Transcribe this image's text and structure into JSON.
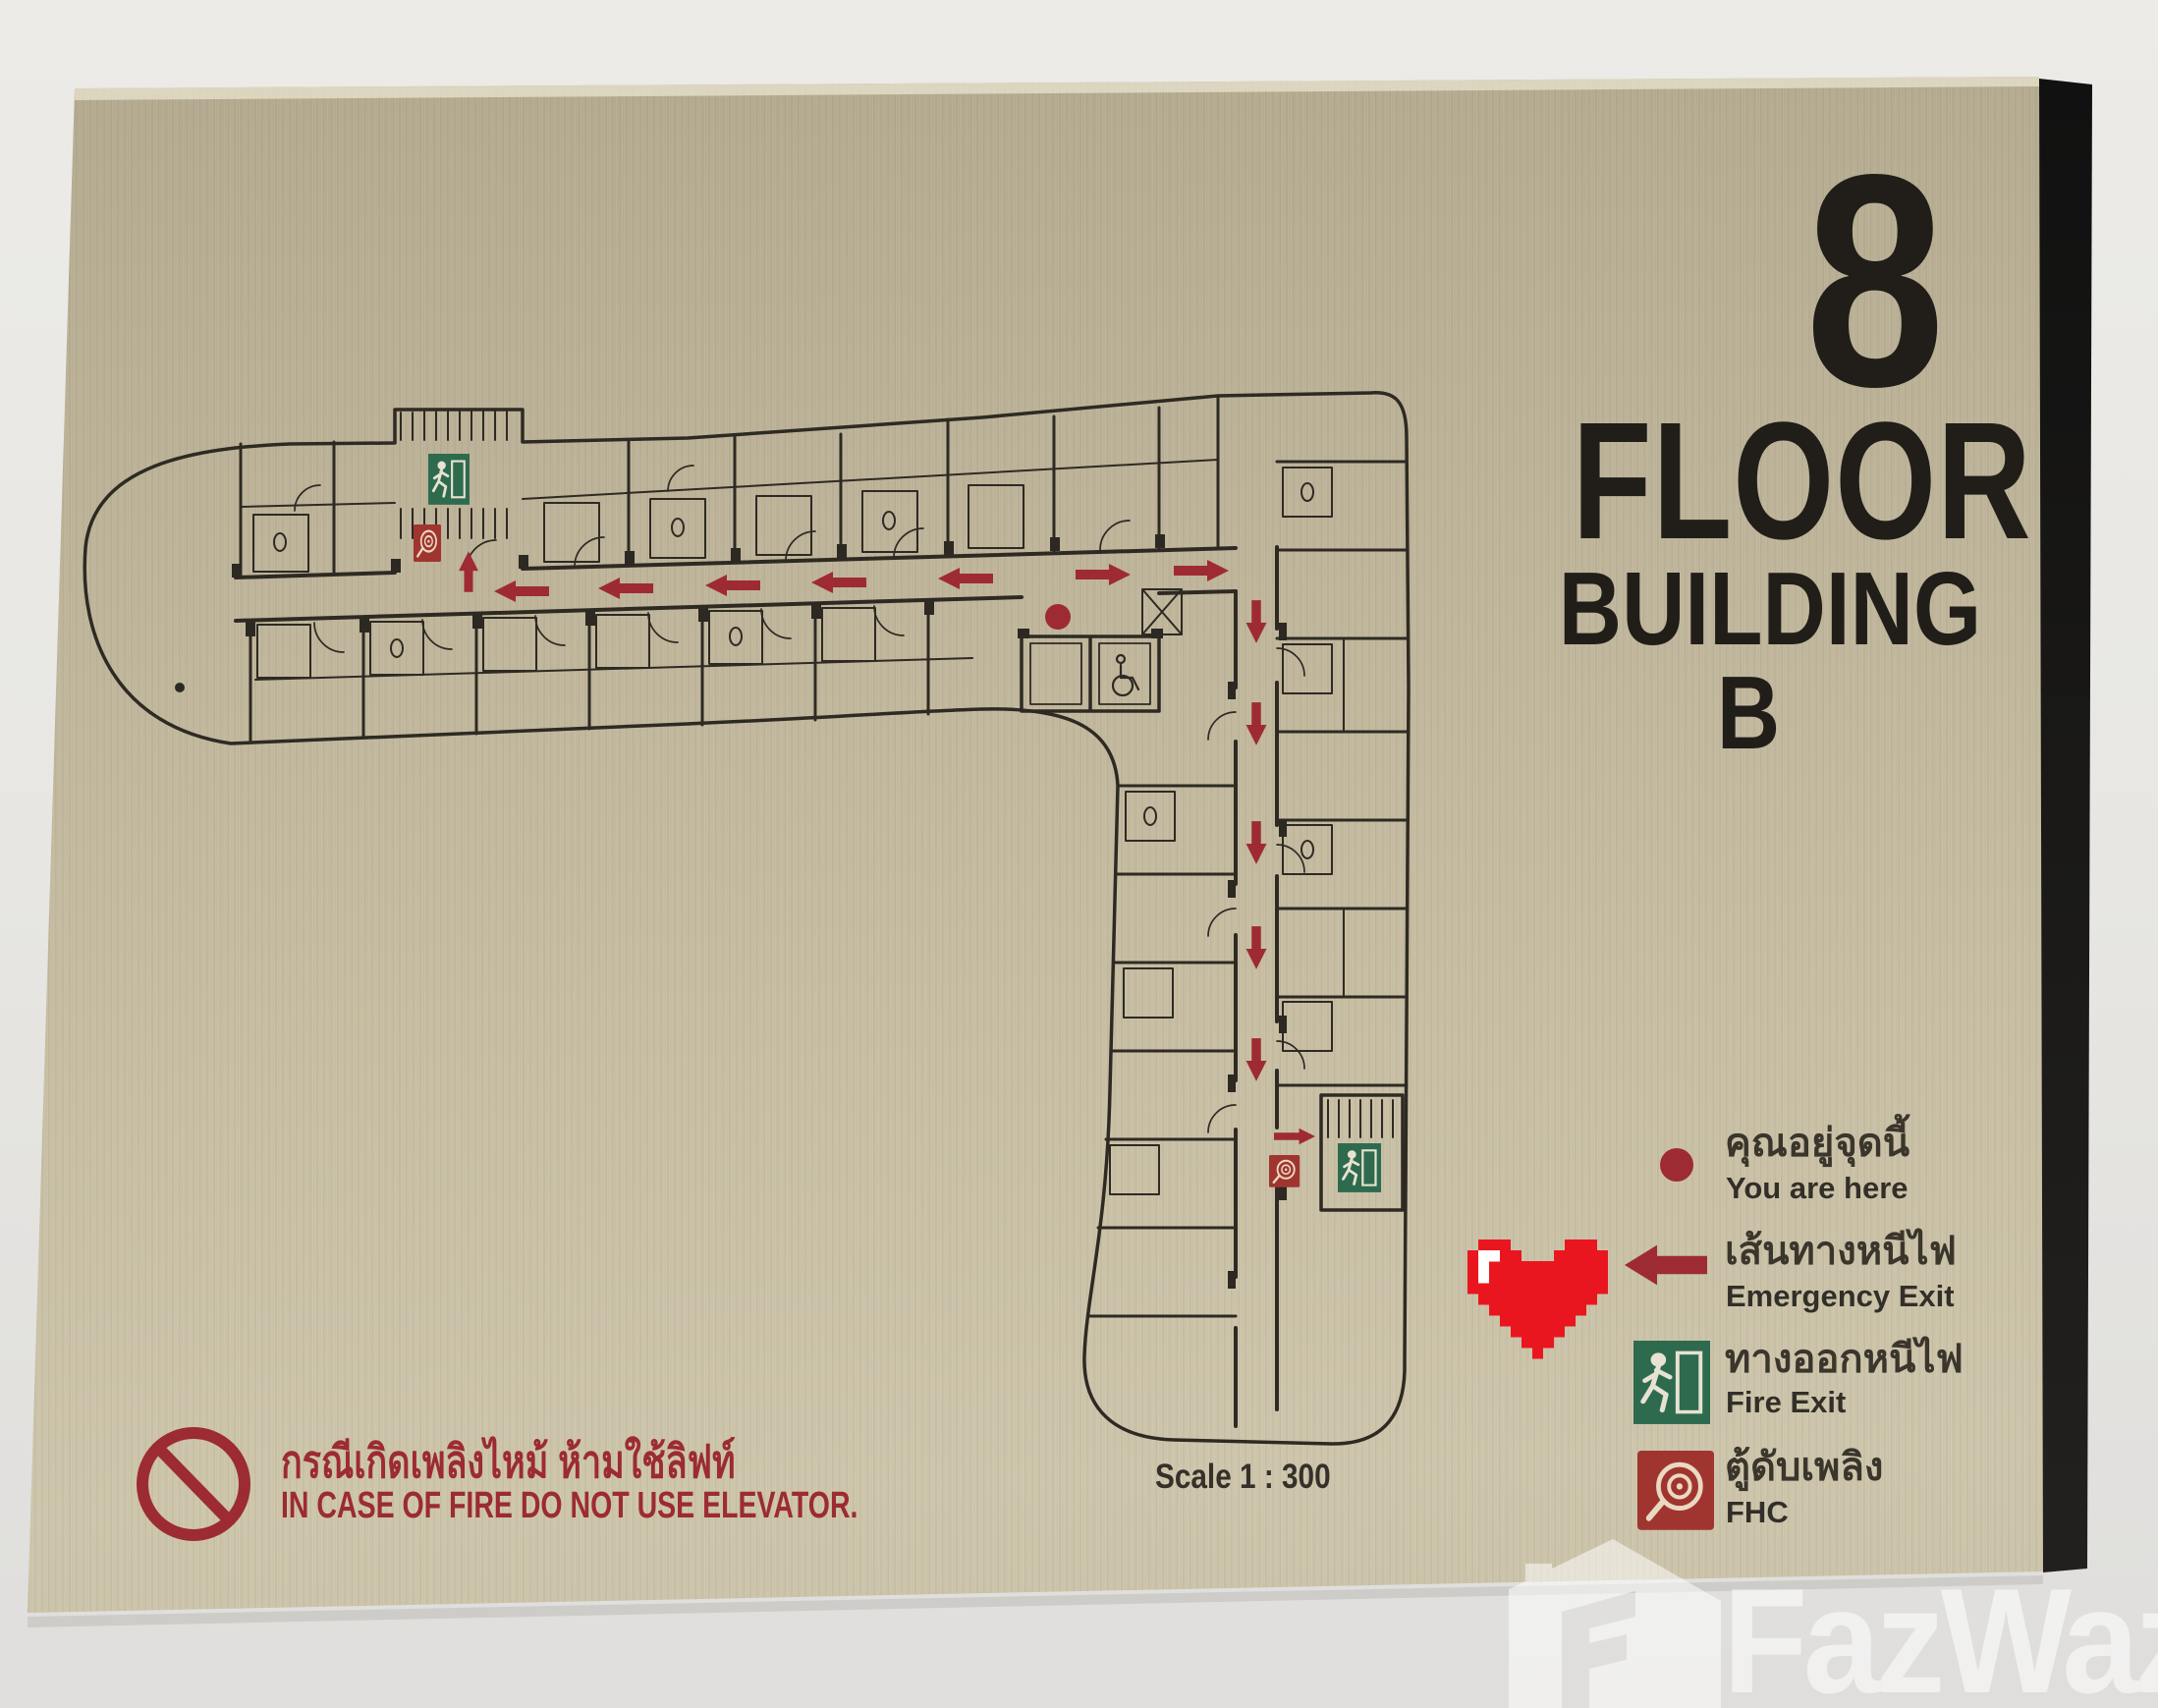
{
  "sign": {
    "floor_number": "8",
    "floor_label": "FLOOR",
    "building_label": "BUILDING B",
    "scale_label": "Scale 1 : 300",
    "legend": [
      {
        "icon": "you-are-here-dot",
        "thai": "คุณอยู่จุดนี้",
        "english": "You are here"
      },
      {
        "icon": "emergency-exit-arrow",
        "thai": "เส้นทางหนีไฟ",
        "english": "Emergency Exit"
      },
      {
        "icon": "fire-exit-sign",
        "thai": "ทางออกหนีไฟ",
        "english": "Fire Exit"
      },
      {
        "icon": "fire-hose-cabinet",
        "thai": "ตู้ดับเพลิง",
        "english": "FHC"
      }
    ],
    "warning": {
      "thai": "กรณีเกิดเพลิงไหม้ ห้ามใช้ลิฟท์",
      "english": "IN CASE OF FIRE DO NOT USE ELEVATOR."
    },
    "colors": {
      "plate_gold": "#c3ba9f",
      "accent_red": "#9e2b33",
      "exit_green": "#2e6b4e",
      "fhc_red": "#a03530",
      "text_black": "#211e19",
      "heart_red": "#ea161f",
      "wall_grey": "#e8e7e3",
      "plan_line": "#2e2a23"
    }
  },
  "watermark": {
    "brand": "FazWaz"
  }
}
